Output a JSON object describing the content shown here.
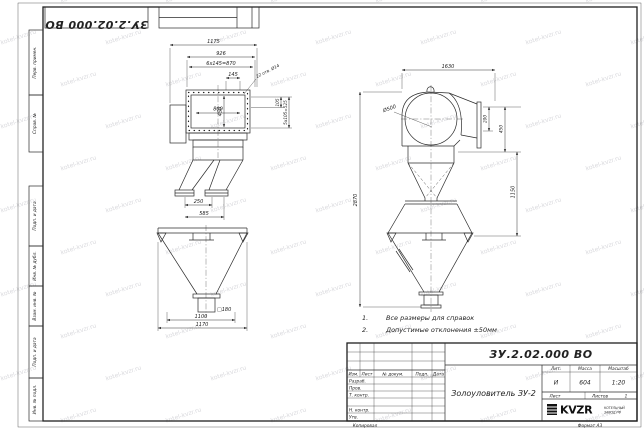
{
  "sheet": {
    "doc_number": "ЗУ.2.02.000 ВО",
    "copied_label": "Копировал",
    "format_label": "Формат А3"
  },
  "margin_labels": [
    "Перв. примен.",
    "Справ. №",
    "Подп. и дата",
    "Инв. № дубл.",
    "Взам. инв. №",
    "Подп. и дата",
    "Инв. № подл."
  ],
  "front_view": {
    "d_1175": "1175",
    "d_926": "926",
    "d_870": "6x145=870",
    "d_145": "145",
    "holes_note": "22 отв. Ø14",
    "d_800": "800",
    "d_450": "450",
    "d_105": "105",
    "d_525": "5x105=525",
    "d_250": "250",
    "d_585": "585",
    "d_sq180": "□180",
    "d_1100": "1100",
    "d_1170": "1170"
  },
  "side_view": {
    "d_1630": "1630",
    "d_500": "Ø500",
    "d_200": "200",
    "d_450": "450",
    "d_2870": "2870",
    "d_1150": "1150"
  },
  "notes": [
    {
      "num": "1.",
      "text": "Все размеры для справок"
    },
    {
      "num": "2.",
      "text": "Допустимые отклонения ±50мм"
    }
  ],
  "title_block": {
    "doc_number": "ЗУ.2.02.000 ВО",
    "name": "Золоуловитель ЗУ-2",
    "header_cols": [
      "Изм.",
      "Лист",
      "№ докум.",
      "Подп.",
      "Дата"
    ],
    "sign_rows": [
      "Разраб.",
      "Пров.",
      "Т. контр.",
      "Н. контр.",
      "Утв."
    ],
    "lit_label": "Лит.",
    "lit_value": "И",
    "mass_label": "Масса",
    "mass_value": "604",
    "scale_label": "Масштаб",
    "scale_value": "1:20",
    "sheet_label": "Лист",
    "sheets_label": "Листов",
    "sheets_value": "1",
    "logo_text": "KVZR",
    "company_line1": "КОТЕЛЬНЫЙ",
    "company_line2": "ЗАВОД.РФ"
  },
  "watermark": {
    "text": "kotel-kvzr.ru"
  },
  "colors": {
    "line": "#2b2b2b",
    "paper": "#ffffff"
  }
}
